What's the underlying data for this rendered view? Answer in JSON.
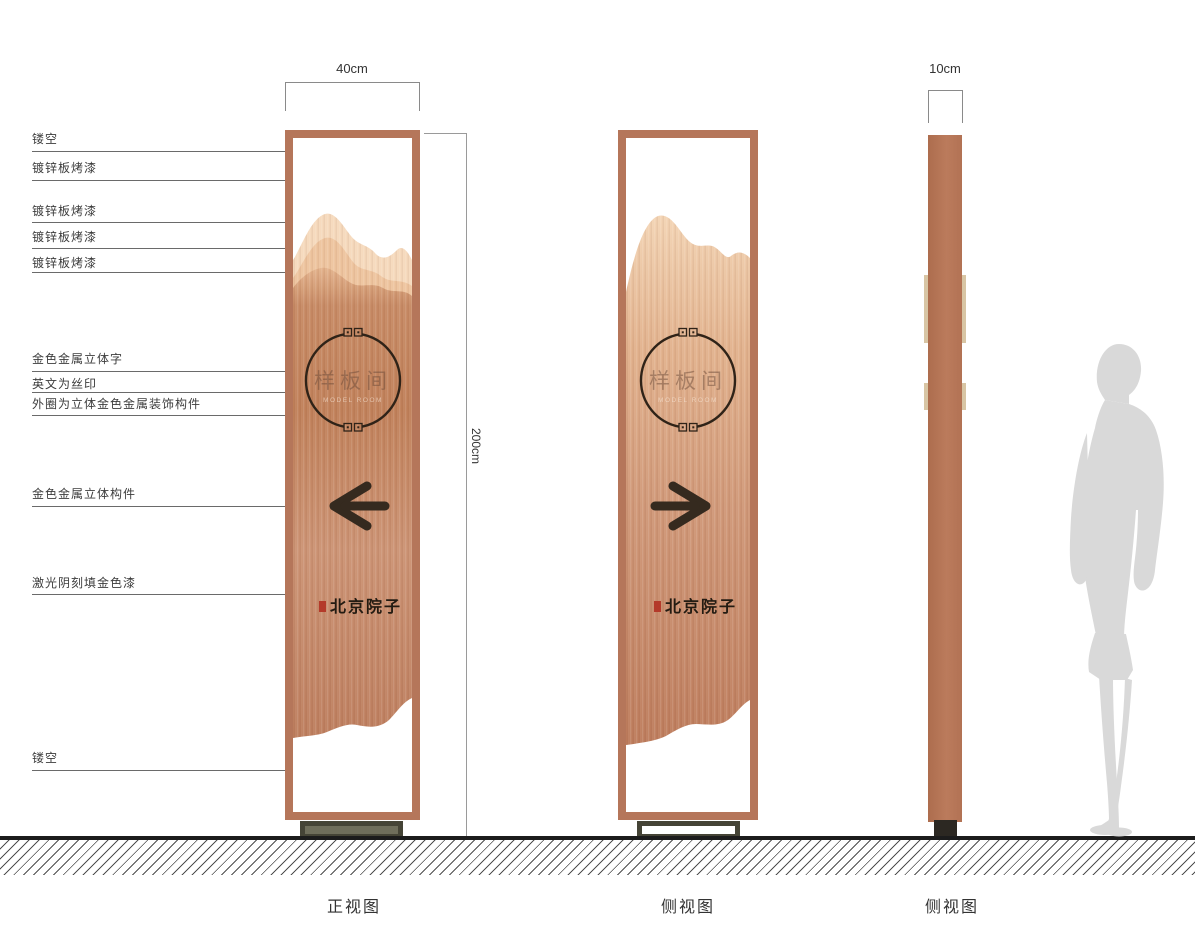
{
  "drawing": {
    "type": "signage-design-elevation",
    "brand_color": "#b5765a",
    "seal_color": "#b43a2a",
    "ground_color": "#1c1c1c",
    "silhouette_color": "#d9d9d9"
  },
  "annotations": [
    {
      "label": "镂空",
      "text_y": 130,
      "line_y": 151,
      "x_end": 306
    },
    {
      "label": "镀锌板烤漆",
      "text_y": 159,
      "line_y": 180,
      "x_end": 285
    },
    {
      "label": "镀锌板烤漆",
      "text_y": 202,
      "line_y": 222,
      "x_end": 323
    },
    {
      "label": "镀锌板烤漆",
      "text_y": 228,
      "line_y": 248,
      "x_end": 292
    },
    {
      "label": "镀锌板烤漆",
      "text_y": 254,
      "line_y": 272,
      "x_end": 292
    },
    {
      "label": "金色金属立体字",
      "text_y": 350,
      "line_y": 371,
      "x_end": 325
    },
    {
      "label": "英文为丝印",
      "text_y": 375,
      "line_y": 392,
      "x_end": 333
    },
    {
      "label": "外圈为立体金色金属装饰构件",
      "text_y": 395,
      "line_y": 415,
      "x_end": 317
    },
    {
      "label": "金色金属立体构件",
      "text_y": 485,
      "line_y": 506,
      "x_end": 331
    },
    {
      "label": "激光阴刻填金色漆",
      "text_y": 574,
      "line_y": 594,
      "x_end": 300
    },
    {
      "label": "镂空",
      "text_y": 749,
      "line_y": 770,
      "x_end": 302
    }
  ],
  "dimensions": {
    "front_width": "40cm",
    "height": "200cm",
    "side_width": "10cm"
  },
  "views": [
    {
      "label": "正视图"
    },
    {
      "label": "侧视图"
    },
    {
      "label": "侧视图"
    }
  ],
  "sign": {
    "room_name": "样板间",
    "room_name_en": "MODEL ROOM",
    "brand": "北京院子",
    "front_arrow": "left",
    "side_arrow": "right"
  }
}
